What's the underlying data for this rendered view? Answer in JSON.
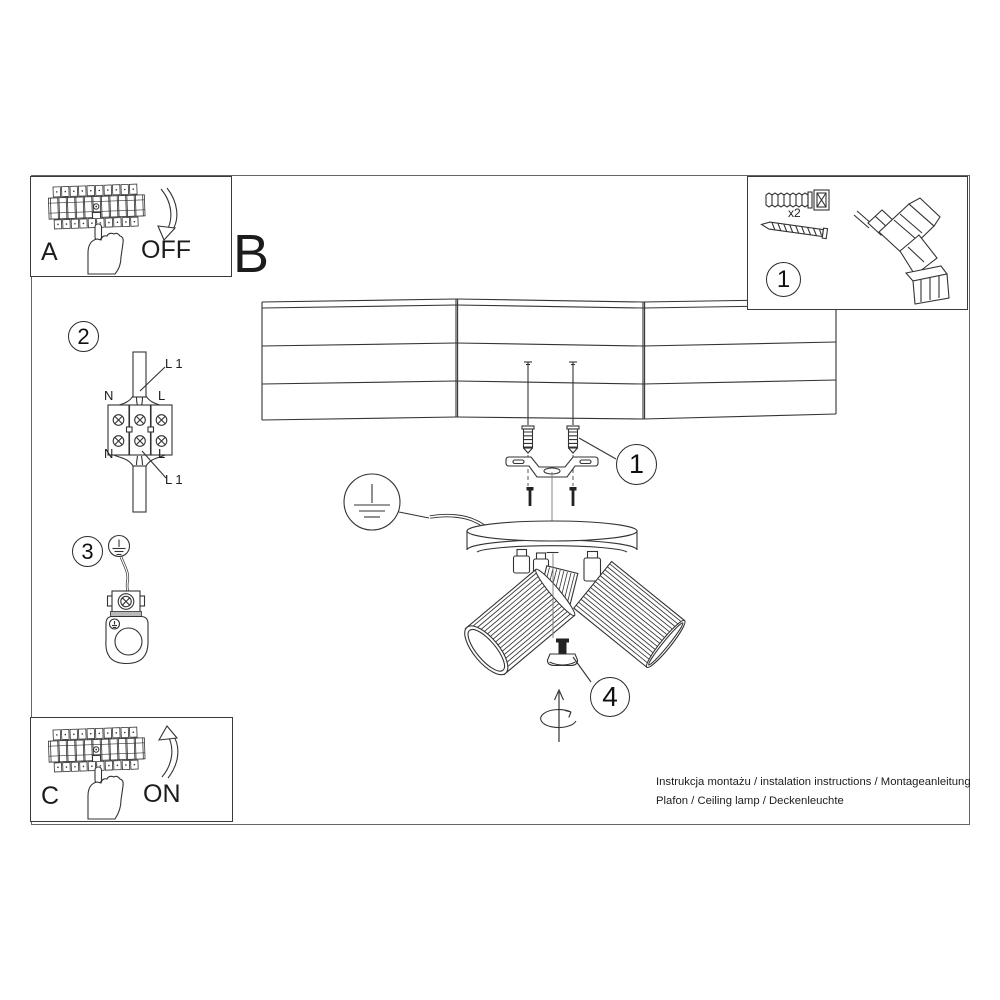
{
  "colors": {
    "line": "#333333",
    "background": "#ffffff"
  },
  "title_letter": "B",
  "panel_box_a": {
    "label": "A",
    "switch_state": "OFF"
  },
  "panel_box_c": {
    "label": "C",
    "switch_state": "ON"
  },
  "parts_box": {
    "step_number": "1",
    "anchor_qty": "x2"
  },
  "step_callouts": {
    "mounting": "1",
    "wiring": "2",
    "ground": "3",
    "adjust": "4"
  },
  "wiring_diagram": {
    "top_left": "N",
    "top_right": "L",
    "bottom_left": "N",
    "bottom_right": "L",
    "line_top": "L 1",
    "line_bottom": "L 1"
  },
  "footer": {
    "line1": "Instrukcja montażu / instalation instructions / Montageanleitung",
    "line2": "Plafon / Ceiling lamp / Deckenleuchte"
  }
}
